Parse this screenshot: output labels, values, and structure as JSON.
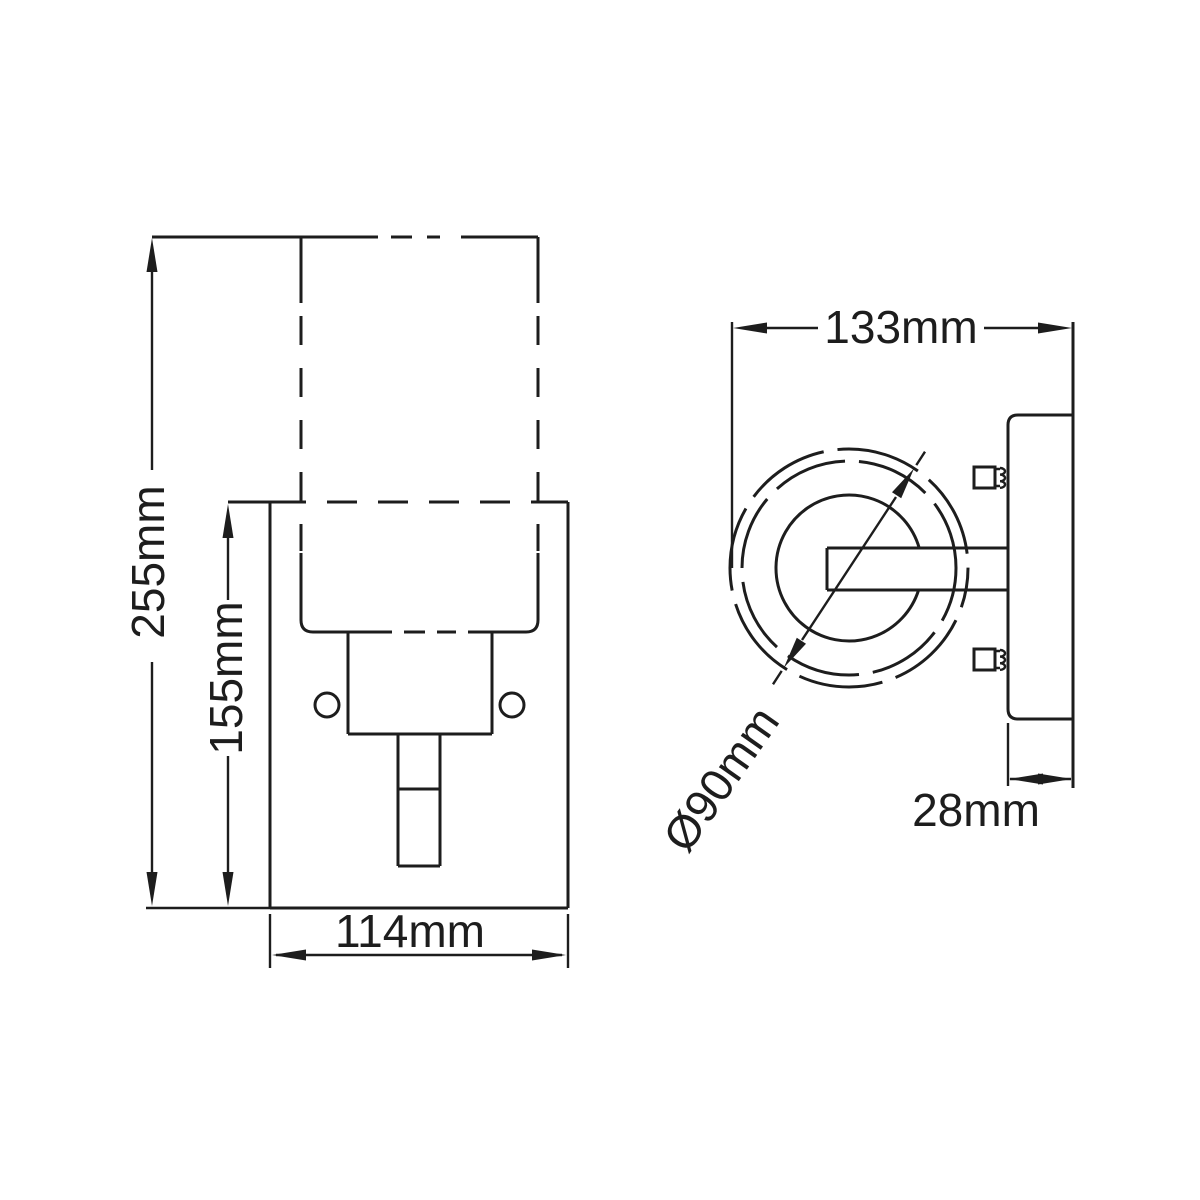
{
  "page": {
    "background": "#ffffff",
    "line_color": "#1d1d1d",
    "description": "Technical dimension drawing of a wall light (front view and side view)"
  },
  "front_view": {
    "overall_height": "255mm",
    "backplate_height": "155mm",
    "backplate_width": "114mm"
  },
  "side_view": {
    "overall_depth": "133mm",
    "shade_diameter": "Ø90mm",
    "backplate_depth": "28mm"
  }
}
